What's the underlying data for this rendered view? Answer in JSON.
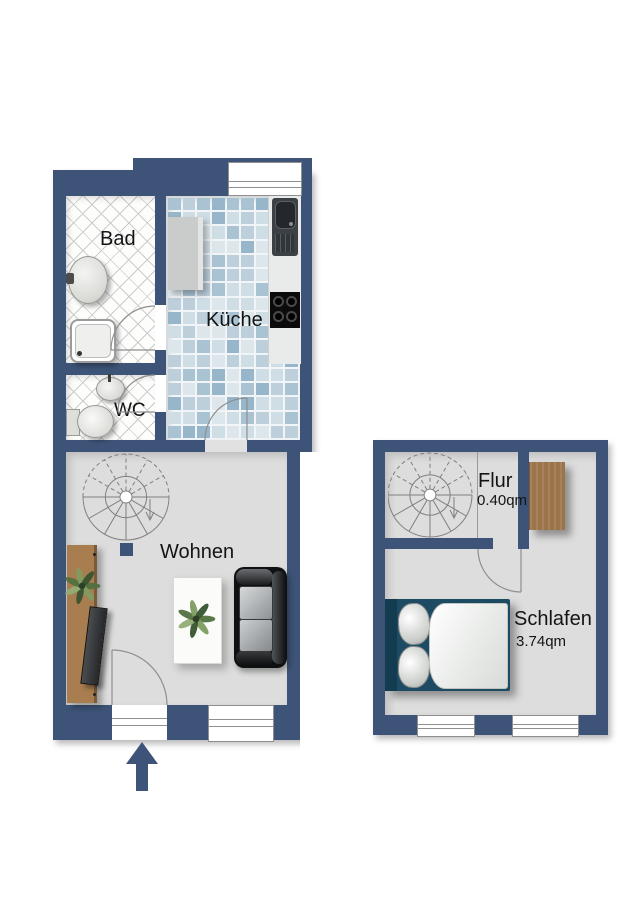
{
  "colors": {
    "wall": "#3d5377",
    "living_floor": "#dcdddc",
    "bath_tile": "#fdfdfc",
    "bath_tile_line": "#cccccc",
    "kitchen_grout": "#f1f5f7",
    "kitchen_tile_palette": [
      "#cfdde5",
      "#bccfdb",
      "#a9c3d3",
      "#dce6eb",
      "#97b6ca"
    ],
    "wood": "#a87e50",
    "wardrobe_wood": "#9c744a",
    "bed_frame": "#1d4b63",
    "text": "#141414",
    "entry_arrow": "#3d5377"
  },
  "ground_floor": {
    "rooms": {
      "bad": {
        "label": "Bad"
      },
      "kueche": {
        "label": "Küche"
      },
      "wc": {
        "label": "WC"
      },
      "wohnen": {
        "label": "Wohnen"
      }
    }
  },
  "upper_floor": {
    "rooms": {
      "flur": {
        "label": "Flur",
        "area": "0.40qm"
      },
      "schlafen": {
        "label": "Schlafen",
        "area": "3.74qm"
      }
    }
  }
}
